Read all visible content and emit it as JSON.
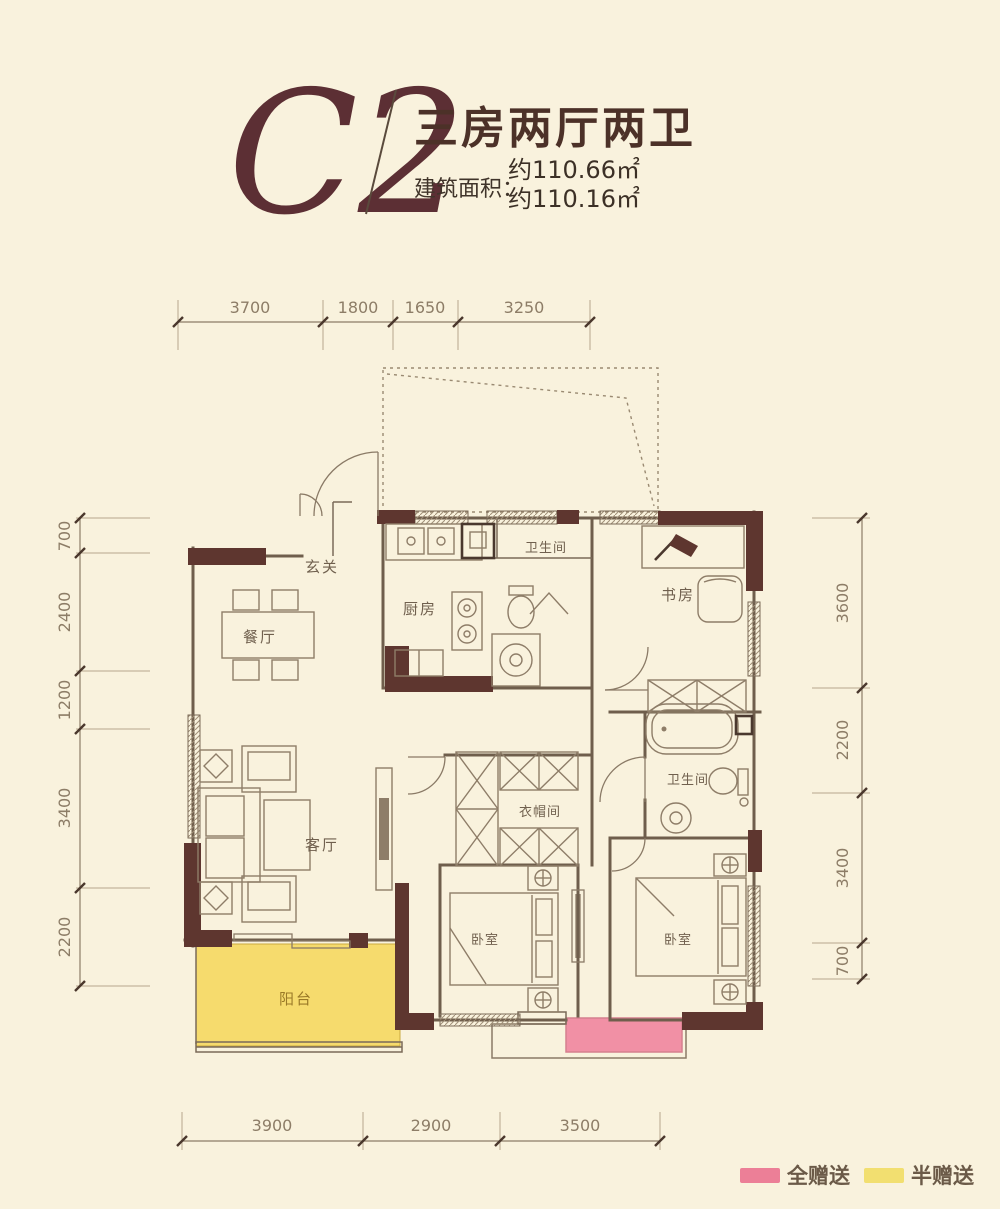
{
  "title": {
    "plan_code": "C2",
    "layout_name": "三房两厅两卫",
    "area_prefix": "建筑面积：",
    "area_value_1": "约110.66㎡",
    "area_value_2": "约110.16㎡"
  },
  "dimensions": {
    "top": [
      "3700",
      "1800",
      "1650",
      "3250"
    ],
    "left": [
      "700",
      "2400",
      "1200",
      "3400",
      "2200"
    ],
    "right": [
      "3600",
      "2200",
      "3400",
      "700"
    ],
    "bottom": [
      "3900",
      "2900",
      "3500"
    ]
  },
  "rooms": {
    "entry": "玄关",
    "dining": "餐厅",
    "kitchen": "厨房",
    "bath_top": "卫生间",
    "study": "书房",
    "living": "客厅",
    "cloakroom": "衣帽间",
    "bath_mid": "卫生间",
    "bedroom_left": "卧室",
    "bedroom_right": "卧室",
    "balcony": "阳台"
  },
  "legend": {
    "full_gift": {
      "label": "全赠送",
      "color": "#ec7f97"
    },
    "half_gift": {
      "label": "半赠送",
      "color": "#f2df70"
    }
  },
  "colors": {
    "background": "#f9f2dd",
    "wall": "#5e362f",
    "balcony_fill": "#f6db6d",
    "gift_fill": "#f190a5",
    "plan_code": "#5c2f34",
    "title_text": "#4c3128"
  }
}
